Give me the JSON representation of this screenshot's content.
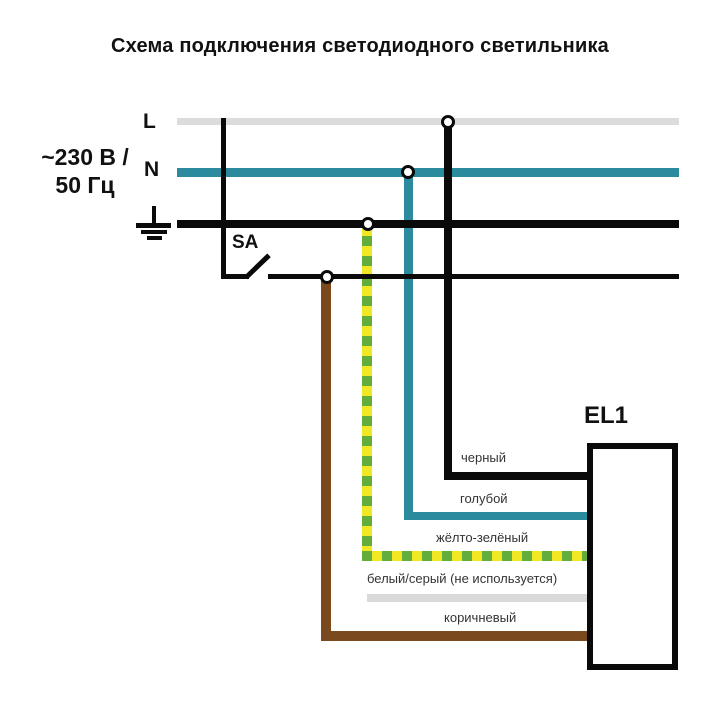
{
  "title": "Схема подключения светодиодного светильника",
  "source": {
    "line1": "~230 В /",
    "line2": "50 Гц"
  },
  "bus": {
    "l": "L",
    "n": "N"
  },
  "switch_label": "SA",
  "luminaire_label": "EL1",
  "wires": [
    {
      "name": "black",
      "label": "черный"
    },
    {
      "name": "blue",
      "label": "голубой"
    },
    {
      "name": "yellow-green",
      "label": "жёлто-зелёный"
    },
    {
      "name": "white-gray",
      "label": "белый/серый (не используется)"
    },
    {
      "name": "brown",
      "label": "коричневый"
    }
  ],
  "colors": {
    "line-black": "#0a0a0a",
    "line-gray": "#dcdcdc",
    "teal": "#2b8a9d",
    "yellow": "#f2e723",
    "green": "#62ad3c",
    "brown": "#7a4a1e",
    "wire-gray": "#d9d9d9",
    "label": "#343434"
  }
}
